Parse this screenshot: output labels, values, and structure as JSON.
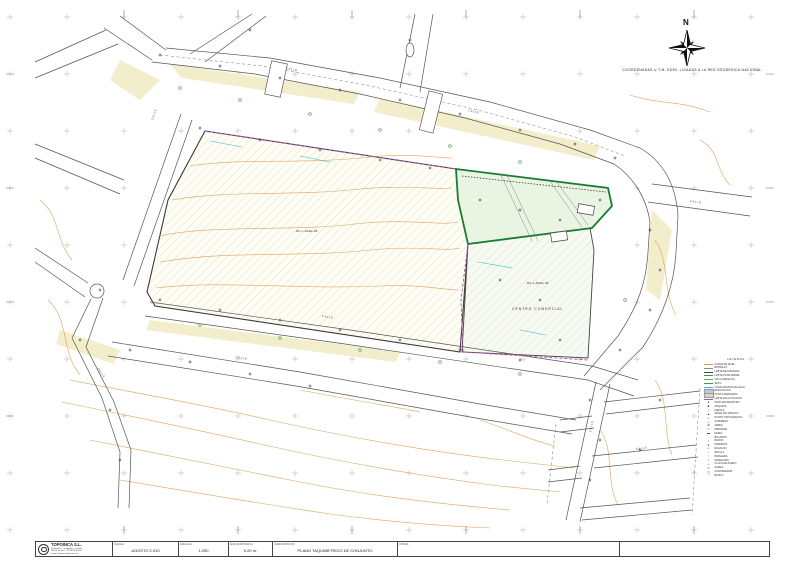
{
  "sheet": {
    "north_label": "N",
    "coordinates_note": "COORDENADAS U.T.M. ED50, LIGADAS A LA RED GEODESICA NACIONAL"
  },
  "drawing": {
    "parcel_labels": [
      {
        "text": "MC-1 AREA 2B"
      },
      {
        "text": "MC-1 AREA 2B"
      }
    ],
    "commercial_label": "CENTRO COMERCIAL",
    "street_labels": [
      {
        "text": "CALLE",
        "x": 286,
        "y": 66,
        "rot": 11
      },
      {
        "text": "CALLE",
        "x": 468,
        "y": 108,
        "rot": 13
      },
      {
        "text": "CALLE",
        "x": 322,
        "y": 314,
        "rot": 8
      },
      {
        "text": "CALLE",
        "x": 236,
        "y": 355,
        "rot": 9
      },
      {
        "text": "CALLE",
        "x": 690,
        "y": 199,
        "rot": 7
      },
      {
        "text": "CALLE",
        "x": 636,
        "y": 447,
        "rot": -7
      },
      {
        "text": "CALLE",
        "x": 590,
        "y": 430,
        "rot": -78
      },
      {
        "text": "CALLE",
        "x": 98,
        "y": 366,
        "rot": 55
      },
      {
        "text": "CALLE",
        "x": 152,
        "y": 118,
        "rot": -70
      }
    ]
  },
  "legend": {
    "title": "LEYENDA",
    "items": [
      {
        "type": "line",
        "color": "#d99a4e",
        "label": "CURVA DE NIVEL"
      },
      {
        "type": "line",
        "color": "#8a8a8a",
        "label": "BORDILLO"
      },
      {
        "type": "line",
        "color": "#444444",
        "label": "LIMITE DE MANZANA"
      },
      {
        "type": "line",
        "color": "#3f9a3f",
        "label": "LIMITE ZONA VERDE"
      },
      {
        "type": "line",
        "color": "#8a8a8a",
        "label": "VALLA METALICA"
      },
      {
        "type": "line",
        "color": "#3f9a3f",
        "label": "SETO"
      },
      {
        "type": "line",
        "color": "#38b6c9",
        "label": "CANALIZACION DE AGUA"
      },
      {
        "type": "box",
        "color": "#c9c4ef",
        "label": "EDIFICACION"
      },
      {
        "type": "box",
        "color": "#bfe4bb",
        "label": "ZONA AJARDINADA"
      },
      {
        "type": "line",
        "color": "#b44fb4",
        "label": "LIMITE DE ACTUACION"
      },
      {
        "type": "sym",
        "glyph": "●",
        "label": "POZO DE REGISTRO"
      },
      {
        "type": "sym",
        "glyph": "■",
        "label": "ARQUETA"
      },
      {
        "type": "sym",
        "glyph": "○",
        "label": "FAROLA"
      },
      {
        "type": "sym",
        "glyph": "▲",
        "label": "SEÑAL DE TRAFICO"
      },
      {
        "type": "sym",
        "glyph": "+",
        "label": "PUNTO TOPOGRAFICO"
      },
      {
        "type": "sym",
        "glyph": "◇",
        "label": "SUMIDERO"
      },
      {
        "type": "sym",
        "glyph": "⊕",
        "label": "ARBOL"
      },
      {
        "type": "sym",
        "glyph": "□",
        "label": "IMBORNAL"
      },
      {
        "type": "sym",
        "glyph": "▬",
        "label": "MURO"
      },
      {
        "type": "sym",
        "glyph": "◦",
        "label": "BOLARDO"
      },
      {
        "type": "sym",
        "glyph": "▪",
        "label": "BUZON"
      },
      {
        "type": "sym",
        "glyph": "●",
        "label": "HIDRANTE"
      },
      {
        "type": "sym",
        "glyph": "═",
        "label": "ESCALON"
      },
      {
        "type": "sym",
        "glyph": "▫",
        "label": "REJILLA"
      },
      {
        "type": "sym",
        "glyph": "○",
        "label": "PAPELERA"
      },
      {
        "type": "sym",
        "glyph": "▪",
        "label": "SEMAFORO"
      },
      {
        "type": "sym",
        "glyph": "+",
        "label": "CLAVO DE ACERO"
      },
      {
        "type": "sym",
        "glyph": "▭",
        "label": "ACERA"
      },
      {
        "type": "sym",
        "glyph": "▢",
        "label": "CONTENEDOR"
      },
      {
        "type": "sym",
        "glyph": "○",
        "label": "BANCO"
      }
    ]
  },
  "title_block": {
    "company": {
      "name": "TOPOINCA S.L.",
      "lines": [
        "Topografia - Cartografia - Catastro",
        "Oficina tecnica - Tlf. 968 000 000",
        "e-mail: topoinca@topoinca.es"
      ]
    },
    "fields": [
      {
        "label": "FECHA",
        "value": "AGOSTO 2.010"
      },
      {
        "label": "ESCALA",
        "value": "1:250"
      },
      {
        "label": "EQUIDISTANCIA",
        "value": "0,20 m."
      },
      {
        "label": "DESCRIPCION",
        "value": "PLANO TAQUIMETRICO DE CONJUNTO"
      },
      {
        "label": "FIRMA",
        "value": ""
      }
    ]
  },
  "colors": {
    "contour": "#d99a4e",
    "hatch_yellow": "#ddd8a8",
    "hatch_green": "#cfe6c2",
    "boundary_magenta": "#b44fb4",
    "parcel_green": "#1b7a33",
    "water_cyan": "#38b6c9",
    "road_ink": "#555555",
    "grid_cross": "#c9c9b9"
  }
}
